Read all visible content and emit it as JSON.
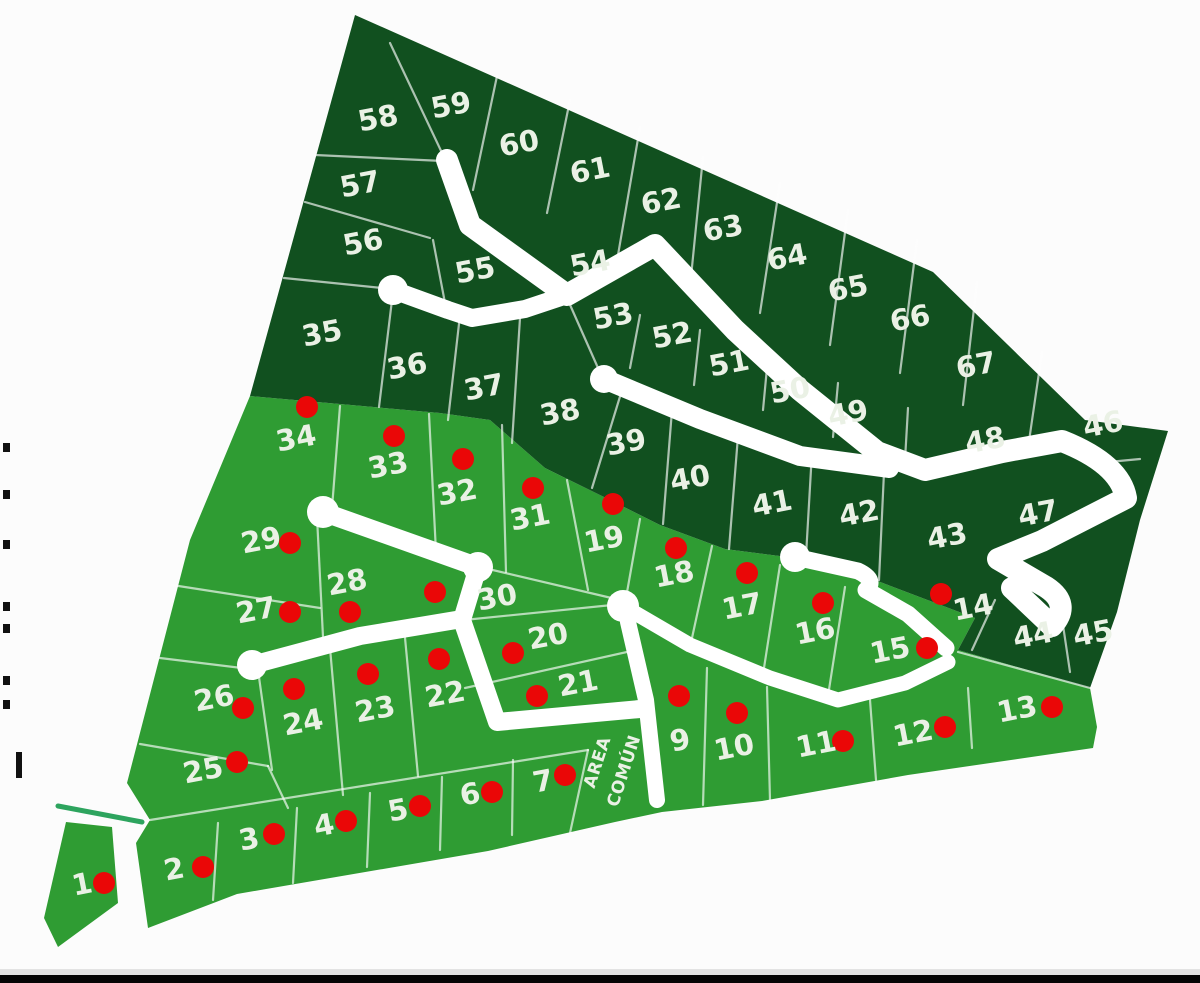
{
  "colors": {
    "background": "#fcfcfc",
    "dark_green": "#11501f",
    "light_green": "#2f9c33",
    "road_white": "#ffffff",
    "boundary_line": "#ffffff",
    "dot_red": "#ea0707",
    "label_color": "#eaf1e5",
    "entrance_green": "#2da45e",
    "bottom_bar_black": "#050505",
    "bottom_bar_gray": "#e3e3e3",
    "edge_mark_black": "#111111"
  },
  "map": {
    "width": 1200,
    "height": 983,
    "regions": {
      "dark": "355,15 933,272 1085,420 1168,431 1140,520 1117,612 1090,688 958,650 975,618 875,580 860,572 795,558 725,549 660,525 610,500 545,468 490,420 440,413 250,396",
      "light": "250,396 440,413 490,420 545,468 610,500 660,525 725,549 795,558 860,572 875,580 975,618 958,650 1090,688 1097,727 1093,748 908,775 762,801 662,812 615,822 488,851 237,894 148,928 136,843 150,820 127,783 190,540",
      "lot1": "66,822 112,827 118,903 58,947 44,918"
    },
    "roads": [
      {
        "d": "M447,160 L470,225 L567,295 L655,245 L735,330 L800,390 L877,452 L925,470 L1002,452 L1062,441 Q1120,464 1126,498 L1042,541 L998,559 L1046,587 Q1072,604 1052,626 L1012,588",
        "w": 22
      },
      {
        "d": "M393,290 L448,310 L472,318 L525,309 L567,295",
        "w": 18
      },
      {
        "d": "M604,379 L700,419 L800,456 L889,468",
        "w": 20
      },
      {
        "d": "M323,512 L478,567",
        "w": 19
      },
      {
        "d": "M478,567 L462,620 L497,722 L640,709",
        "w": 18
      },
      {
        "d": "M252,665 L360,636 L462,619",
        "w": 18
      },
      {
        "d": "M795,557 L858,571 Q877,580 866,590 L908,614 L946,648",
        "w": 17
      },
      {
        "d": "M623,606 L690,645 L770,678 L838,700 L905,683 L948,662",
        "w": 15
      },
      {
        "d": "M628,622 L646,700 L657,800",
        "w": 16
      }
    ],
    "nodes": [
      [
        393,
        290,
        15
      ],
      [
        604,
        379,
        14
      ],
      [
        323,
        512,
        16
      ],
      [
        478,
        567,
        15
      ],
      [
        623,
        606,
        16
      ],
      [
        252,
        665,
        15
      ],
      [
        795,
        557,
        15
      ]
    ],
    "boundary_lines": [
      [
        390,
        43,
        443,
        155
      ],
      [
        497,
        76,
        473,
        190
      ],
      [
        570,
        100,
        547,
        213
      ],
      [
        640,
        127,
        618,
        255
      ],
      [
        703,
        157,
        690,
        287
      ],
      [
        780,
        183,
        760,
        313
      ],
      [
        848,
        210,
        830,
        345
      ],
      [
        917,
        240,
        900,
        373
      ],
      [
        977,
        282,
        963,
        405
      ],
      [
        1042,
        352,
        1028,
        448
      ],
      [
        315,
        155,
        443,
        161
      ],
      [
        305,
        202,
        430,
        238
      ],
      [
        433,
        240,
        445,
        303
      ],
      [
        284,
        278,
        392,
        289
      ],
      [
        392,
        300,
        379,
        407
      ],
      [
        460,
        315,
        448,
        420
      ],
      [
        520,
        318,
        512,
        443
      ],
      [
        567,
        298,
        602,
        377
      ],
      [
        622,
        390,
        592,
        488
      ],
      [
        672,
        410,
        663,
        524
      ],
      [
        738,
        436,
        729,
        549
      ],
      [
        812,
        452,
        806,
        556
      ],
      [
        884,
        472,
        879,
        580
      ],
      [
        640,
        315,
        630,
        368
      ],
      [
        700,
        330,
        694,
        385
      ],
      [
        768,
        357,
        763,
        410
      ],
      [
        838,
        383,
        833,
        437
      ],
      [
        908,
        408,
        905,
        460
      ],
      [
        1098,
        463,
        1140,
        459
      ],
      [
        1060,
        605,
        1070,
        672
      ],
      [
        995,
        600,
        972,
        650
      ],
      [
        958,
        652,
        1090,
        688
      ],
      [
        340,
        406,
        332,
        508
      ],
      [
        429,
        414,
        436,
        552
      ],
      [
        502,
        425,
        506,
        572
      ],
      [
        567,
        480,
        588,
        590
      ],
      [
        640,
        519,
        626,
        598
      ],
      [
        712,
        546,
        692,
        638
      ],
      [
        780,
        565,
        764,
        668
      ],
      [
        845,
        587,
        828,
        696
      ],
      [
        480,
        567,
        620,
        600
      ],
      [
        317,
        517,
        323,
        637
      ],
      [
        172,
        585,
        320,
        608
      ],
      [
        160,
        658,
        258,
        670
      ],
      [
        258,
        670,
        272,
        770
      ],
      [
        140,
        744,
        268,
        766
      ],
      [
        268,
        766,
        288,
        808
      ],
      [
        150,
        820,
        588,
        750
      ],
      [
        218,
        823,
        213,
        900
      ],
      [
        297,
        808,
        293,
        883
      ],
      [
        370,
        793,
        367,
        867
      ],
      [
        442,
        777,
        440,
        850
      ],
      [
        513,
        760,
        512,
        835
      ],
      [
        588,
        750,
        570,
        833
      ],
      [
        464,
        620,
        622,
        604
      ],
      [
        465,
        688,
        636,
        650
      ],
      [
        404,
        627,
        418,
        776
      ],
      [
        330,
        648,
        343,
        795
      ],
      [
        707,
        668,
        703,
        805
      ],
      [
        767,
        687,
        770,
        800
      ],
      [
        870,
        700,
        876,
        780
      ],
      [
        968,
        688,
        972,
        748
      ]
    ],
    "entrance_line": {
      "x1": 58,
      "y1": 806,
      "x2": 142,
      "y2": 822,
      "w": 5
    },
    "label_rotation": -11,
    "lots": [
      {
        "n": "1",
        "x": 82,
        "y": 884,
        "d": [
          104,
          883
        ]
      },
      {
        "n": "2",
        "x": 174,
        "y": 869,
        "d": [
          203,
          867
        ]
      },
      {
        "n": "3",
        "x": 249,
        "y": 839,
        "d": [
          274,
          834
        ]
      },
      {
        "n": "4",
        "x": 324,
        "y": 825,
        "d": [
          346,
          821
        ]
      },
      {
        "n": "5",
        "x": 398,
        "y": 810,
        "d": [
          420,
          806
        ]
      },
      {
        "n": "6",
        "x": 470,
        "y": 794,
        "d": [
          492,
          792
        ]
      },
      {
        "n": "7",
        "x": 543,
        "y": 781,
        "d": [
          565,
          775
        ]
      },
      {
        "n": "9",
        "x": 680,
        "y": 740,
        "d": [
          679,
          696
        ]
      },
      {
        "n": "10",
        "x": 734,
        "y": 747,
        "d": [
          737,
          713
        ]
      },
      {
        "n": "11",
        "x": 816,
        "y": 744,
        "d": [
          843,
          741
        ]
      },
      {
        "n": "12",
        "x": 913,
        "y": 733,
        "d": [
          945,
          727
        ]
      },
      {
        "n": "13",
        "x": 1017,
        "y": 709,
        "d": [
          1052,
          707
        ]
      },
      {
        "n": "14",
        "x": 973,
        "y": 607,
        "d": [
          941,
          594
        ]
      },
      {
        "n": "15",
        "x": 890,
        "y": 650,
        "d": [
          927,
          648
        ]
      },
      {
        "n": "16",
        "x": 815,
        "y": 631,
        "d": [
          823,
          603
        ]
      },
      {
        "n": "17",
        "x": 742,
        "y": 606,
        "d": [
          747,
          573
        ]
      },
      {
        "n": "18",
        "x": 674,
        "y": 574,
        "d": [
          676,
          548
        ]
      },
      {
        "n": "19",
        "x": 604,
        "y": 539,
        "d": [
          613,
          504
        ]
      },
      {
        "n": "20",
        "x": 548,
        "y": 636,
        "d": [
          513,
          653
        ]
      },
      {
        "n": "21",
        "x": 578,
        "y": 683,
        "d": [
          537,
          696
        ]
      },
      {
        "n": "22",
        "x": 445,
        "y": 694,
        "d": [
          439,
          659
        ]
      },
      {
        "n": "23",
        "x": 375,
        "y": 709,
        "d": [
          368,
          674
        ]
      },
      {
        "n": "24",
        "x": 303,
        "y": 722,
        "d": [
          294,
          689
        ]
      },
      {
        "n": "25",
        "x": 203,
        "y": 770,
        "d": [
          237,
          762
        ]
      },
      {
        "n": "26",
        "x": 214,
        "y": 698,
        "d": [
          243,
          708
        ]
      },
      {
        "n": "27",
        "x": 256,
        "y": 610,
        "d": [
          290,
          612
        ]
      },
      {
        "n": "28",
        "x": 347,
        "y": 582,
        "d": [
          350,
          612
        ]
      },
      {
        "n": "29",
        "x": 261,
        "y": 540,
        "d": [
          290,
          543
        ]
      },
      {
        "n": "30",
        "x": 497,
        "y": 597,
        "d": [
          435,
          592
        ]
      },
      {
        "n": "31",
        "x": 530,
        "y": 517,
        "d": [
          533,
          488
        ]
      },
      {
        "n": "32",
        "x": 457,
        "y": 492,
        "d": [
          463,
          459
        ]
      },
      {
        "n": "33",
        "x": 388,
        "y": 465,
        "d": [
          394,
          436
        ]
      },
      {
        "n": "34",
        "x": 296,
        "y": 438,
        "d": [
          307,
          407
        ]
      },
      {
        "n": "35",
        "x": 322,
        "y": 333
      },
      {
        "n": "36",
        "x": 407,
        "y": 366
      },
      {
        "n": "37",
        "x": 484,
        "y": 387
      },
      {
        "n": "38",
        "x": 560,
        "y": 412
      },
      {
        "n": "39",
        "x": 626,
        "y": 442
      },
      {
        "n": "40",
        "x": 690,
        "y": 478
      },
      {
        "n": "41",
        "x": 772,
        "y": 503
      },
      {
        "n": "42",
        "x": 859,
        "y": 513
      },
      {
        "n": "43",
        "x": 947,
        "y": 536
      },
      {
        "n": "44",
        "x": 1033,
        "y": 635
      },
      {
        "n": "45",
        "x": 1093,
        "y": 633
      },
      {
        "n": "46",
        "x": 1103,
        "y": 424
      },
      {
        "n": "47",
        "x": 1038,
        "y": 513
      },
      {
        "n": "48",
        "x": 985,
        "y": 440
      },
      {
        "n": "49",
        "x": 848,
        "y": 413
      },
      {
        "n": "50",
        "x": 790,
        "y": 390
      },
      {
        "n": "51",
        "x": 729,
        "y": 363
      },
      {
        "n": "52",
        "x": 672,
        "y": 335
      },
      {
        "n": "53",
        "x": 613,
        "y": 316
      },
      {
        "n": "54",
        "x": 590,
        "y": 263
      },
      {
        "n": "55",
        "x": 475,
        "y": 270
      },
      {
        "n": "56",
        "x": 363,
        "y": 242
      },
      {
        "n": "57",
        "x": 360,
        "y": 184
      },
      {
        "n": "58",
        "x": 378,
        "y": 118
      },
      {
        "n": "59",
        "x": 451,
        "y": 105
      },
      {
        "n": "60",
        "x": 519,
        "y": 143
      },
      {
        "n": "61",
        "x": 590,
        "y": 170
      },
      {
        "n": "62",
        "x": 661,
        "y": 201
      },
      {
        "n": "63",
        "x": 723,
        "y": 228
      },
      {
        "n": "64",
        "x": 787,
        "y": 257
      },
      {
        "n": "65",
        "x": 848,
        "y": 288
      },
      {
        "n": "66",
        "x": 910,
        "y": 318
      },
      {
        "n": "67",
        "x": 976,
        "y": 365
      }
    ],
    "area_comun": {
      "line1": "AREA",
      "line2": "COMÚN",
      "x": 612,
      "y": 767,
      "rotation": -72,
      "font_size": 17,
      "line_offset": 10
    },
    "edge_marks": [
      [
        3,
        443
      ],
      [
        3,
        490
      ],
      [
        3,
        540
      ],
      [
        3,
        602
      ],
      [
        3,
        624
      ],
      [
        3,
        676
      ],
      [
        3,
        700
      ]
    ],
    "edge_bar": [
      16,
      752,
      6,
      26
    ],
    "bottom_bars": {
      "gray_y": 969,
      "gray_h": 6,
      "black_y": 975,
      "black_h": 8
    }
  }
}
